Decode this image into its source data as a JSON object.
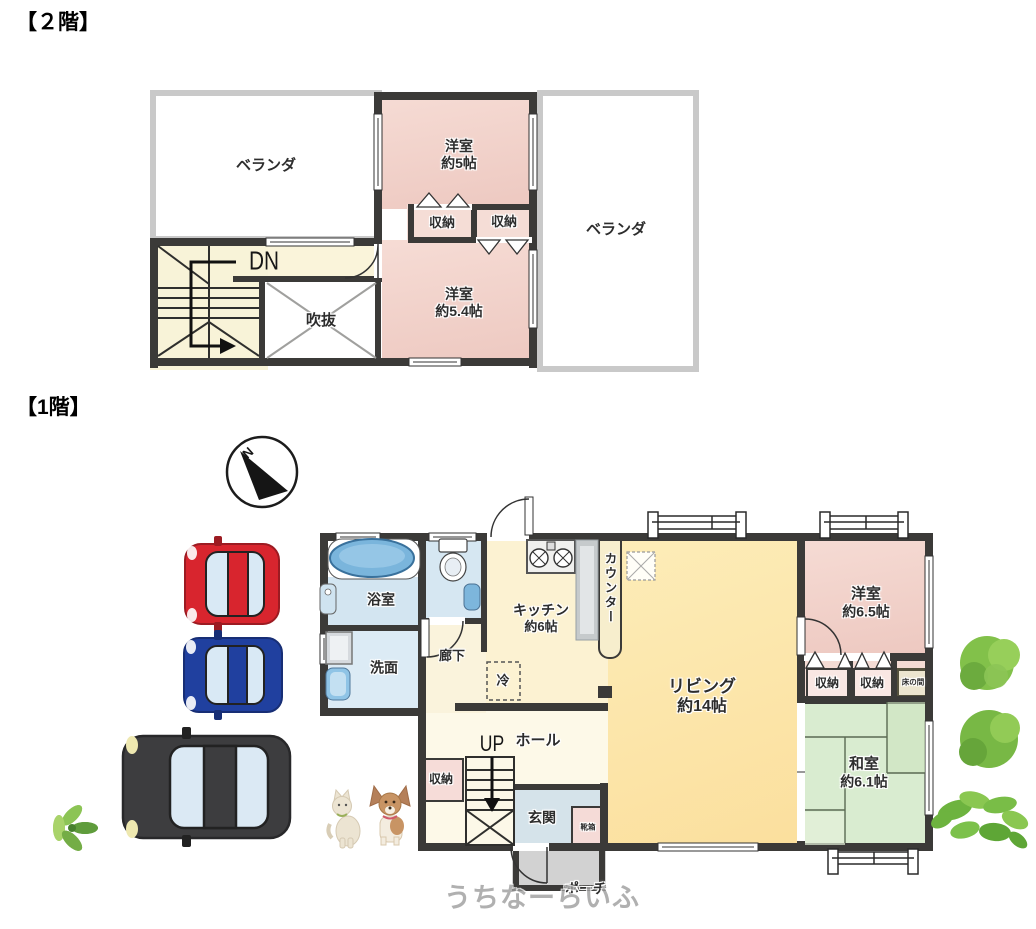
{
  "floor2": {
    "title": "【２階】",
    "veranda_left": "ベランダ",
    "veranda_right": "ベランダ",
    "room_a": {
      "name": "洋室",
      "size": "約5帖"
    },
    "room_b": {
      "name": "洋室",
      "size": "約5.4帖"
    },
    "closet_left": "収納",
    "closet_right": "収納",
    "stairs_label": "DN",
    "void_label": "吹抜"
  },
  "floor1": {
    "title": "【1階】",
    "compass": "N",
    "bath": "浴室",
    "washroom": "洗面",
    "corridor": "廊下",
    "kitchen": {
      "name": "キッチン",
      "size": "約6帖"
    },
    "counter": "カウンター",
    "fridge": "冷",
    "living": {
      "name": "リビング",
      "size": "約14帖"
    },
    "western_room": {
      "name": "洋室",
      "size": "約6.5帖"
    },
    "closet_a": "収納",
    "closet_b": "収納",
    "tokonoma": "床の間",
    "japanese_room": {
      "name": "和室",
      "size": "約6.1帖"
    },
    "hall": "ホール",
    "stairs_label": "UP",
    "hall_closet": "収納",
    "entrance": "玄関",
    "shoe_box": "靴箱",
    "porch": "ポーチ"
  },
  "watermark": "うちなーらいふ",
  "colors": {
    "wall": "#3b3a38",
    "room_pink": "#f2d2ca",
    "tatami_green": "#d9ecd0",
    "living_yellow": "#fce5a6",
    "water_blue": "#d6e7f2",
    "porch_gray": "#d2d2d2",
    "car_red": "#d8252e",
    "car_blue": "#20409f",
    "car_black": "#3d3d3f"
  }
}
